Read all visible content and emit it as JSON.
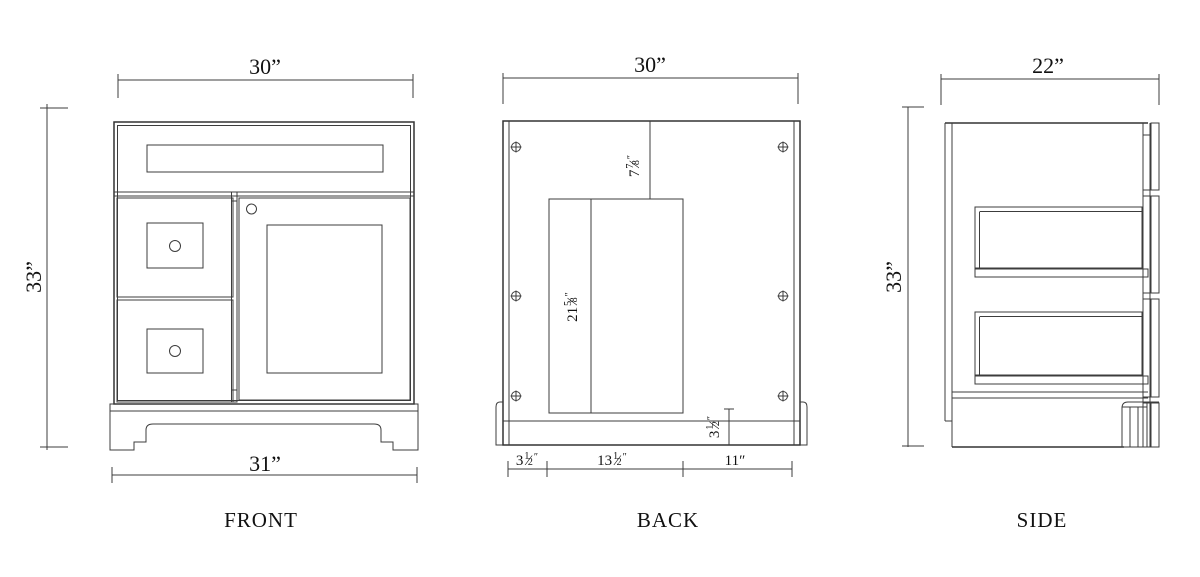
{
  "drawing": {
    "background": "#ffffff",
    "line_color": "#3c3c3c",
    "views": {
      "front": {
        "label": "FRONT",
        "dim_top": "30”",
        "dim_left": "33”",
        "dim_bottom": "31”"
      },
      "back": {
        "label": "BACK",
        "dim_top": "30”",
        "dim_drop": {
          "whole": "7",
          "num": "7",
          "slash": "⁄",
          "den": "8",
          "unit": "″"
        },
        "dim_opening": {
          "whole": "21",
          "num": "5",
          "slash": "⁄",
          "den": "8",
          "unit": "″"
        },
        "dim_bottom_rail": {
          "whole": "3",
          "num": "1",
          "slash": "⁄",
          "den": "2",
          "unit": "″"
        },
        "dim_seg_left": {
          "whole": "3",
          "num": "1",
          "slash": "⁄",
          "den": "2",
          "unit": "″"
        },
        "dim_seg_mid": {
          "whole": "13",
          "num": "1",
          "slash": "⁄",
          "den": "2",
          "unit": "″"
        },
        "dim_seg_right": "11″"
      },
      "side": {
        "label": "SIDE",
        "dim_top": "22”",
        "dim_left": "33”"
      }
    }
  }
}
